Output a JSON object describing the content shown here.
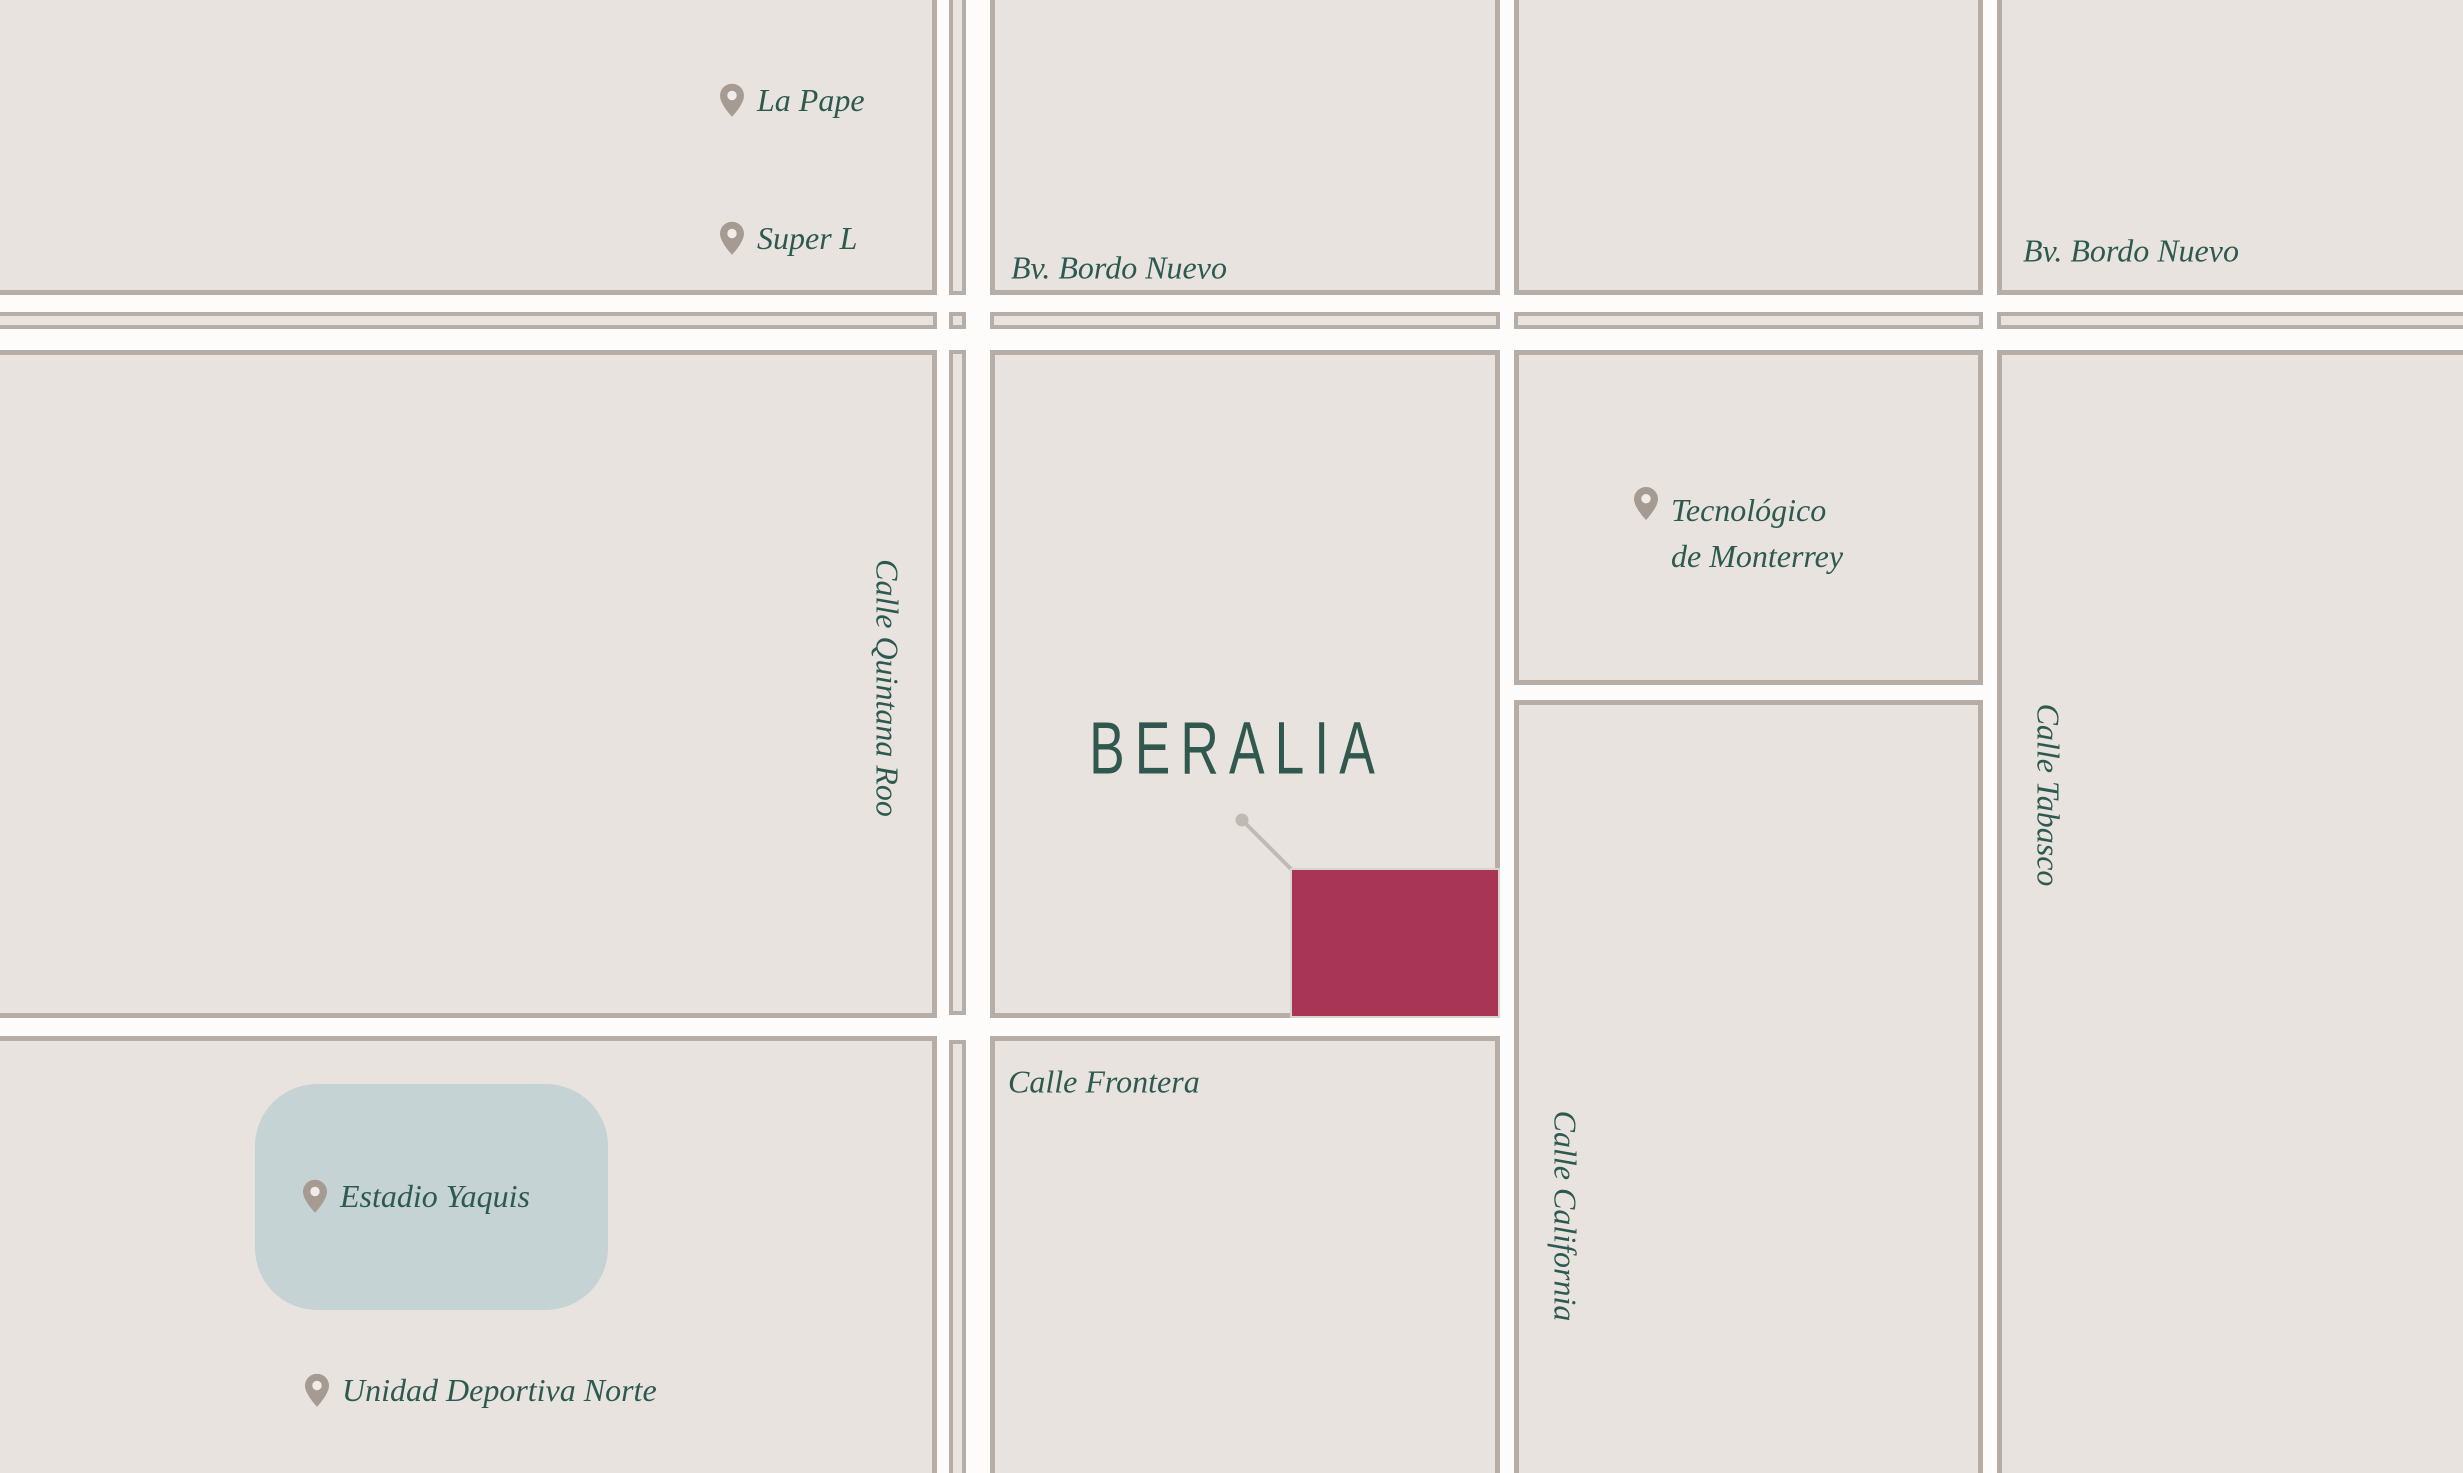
{
  "colors": {
    "street": "#fdfcfa",
    "block": "#e8e3de",
    "border": "#b6ada7",
    "label": "#2d5a50",
    "title": "#31584e",
    "pin": "#a69b92",
    "pin-hole": "#f1ece8",
    "highlight": "#a93556",
    "highlight-border": "#d8d3ce",
    "park": "#c6d3d4",
    "leader": "#c0bab4"
  },
  "project": {
    "name": "BERALIA"
  },
  "streets": {
    "bordo_nuevo_center": "Bv. Bordo Nuevo",
    "bordo_nuevo_east": "Bv. Bordo Nuevo",
    "quintana_roo": "Calle Quintana Roo",
    "frontera": "Calle Frontera",
    "california": "Calle California",
    "tabasco": "Calle Tabasco"
  },
  "pois": {
    "la_pape": "La Pape",
    "super_l": "Super L",
    "tec_line1": "Tecnológico",
    "tec_line2": "de Monterrey",
    "estadio": "Estadio Yaquis",
    "unidad": "Unidad Deportiva Norte"
  }
}
